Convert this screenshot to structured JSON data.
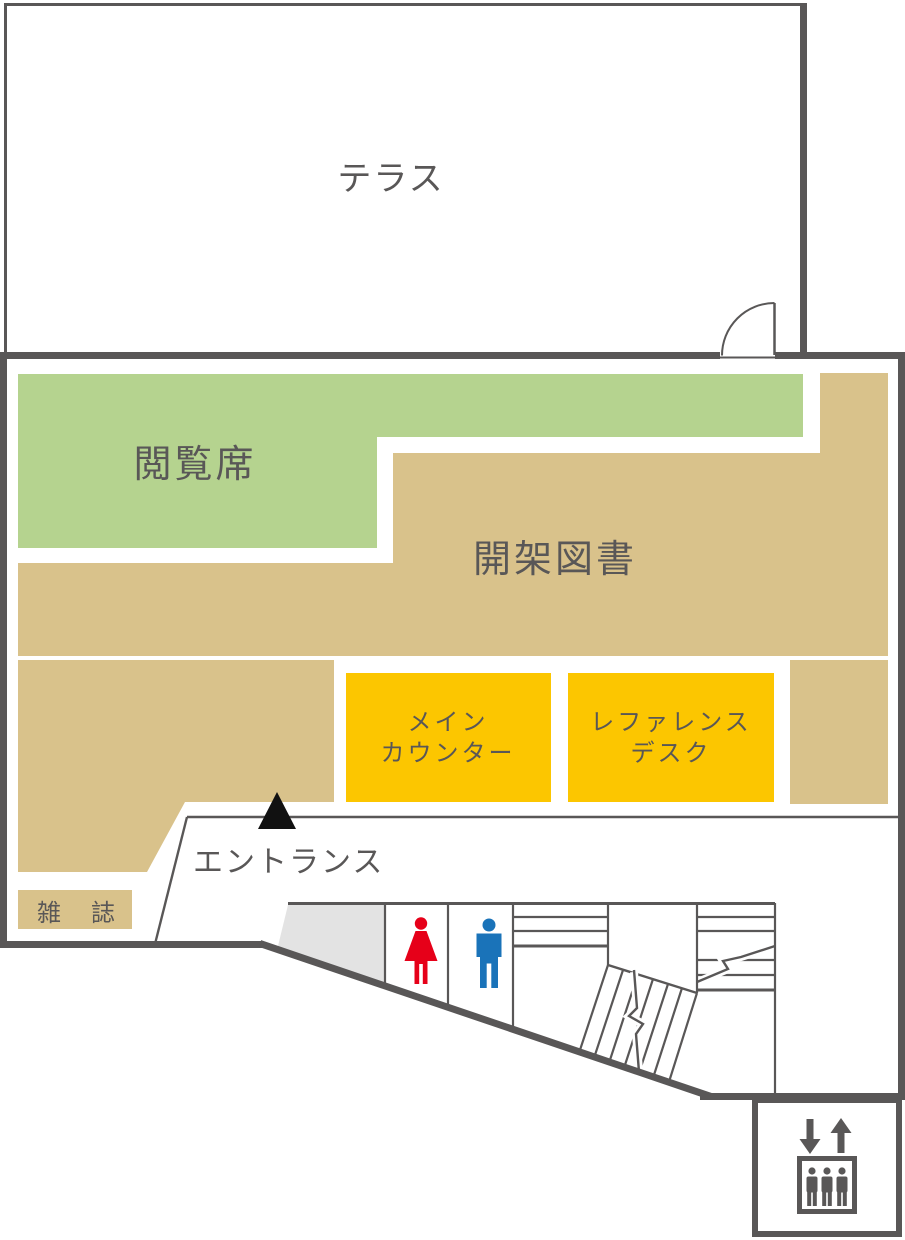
{
  "colors": {
    "wall": "#595757",
    "text": "#595757",
    "reading_green": "#b5d38f",
    "stacks_tan": "#d9c28b",
    "counter_yellow": "#fcc600",
    "slope_gray": "#e3e3e3",
    "female_red": "#e60019",
    "male_blue": "#1a73b9",
    "marker_black": "#111111",
    "white": "#ffffff"
  },
  "rooms": {
    "terrace": {
      "label": "テラス"
    },
    "reading_seats": {
      "label": "閲覧席"
    },
    "open_stacks": {
      "label": "開架図書"
    },
    "main_counter": {
      "line1": "メイン",
      "line2": "カウンター"
    },
    "reference_desk": {
      "line1": "レファレンス",
      "line2": "デスク"
    },
    "entrance": {
      "label": "エントランス"
    },
    "magazines": {
      "label": "雑誌"
    }
  }
}
